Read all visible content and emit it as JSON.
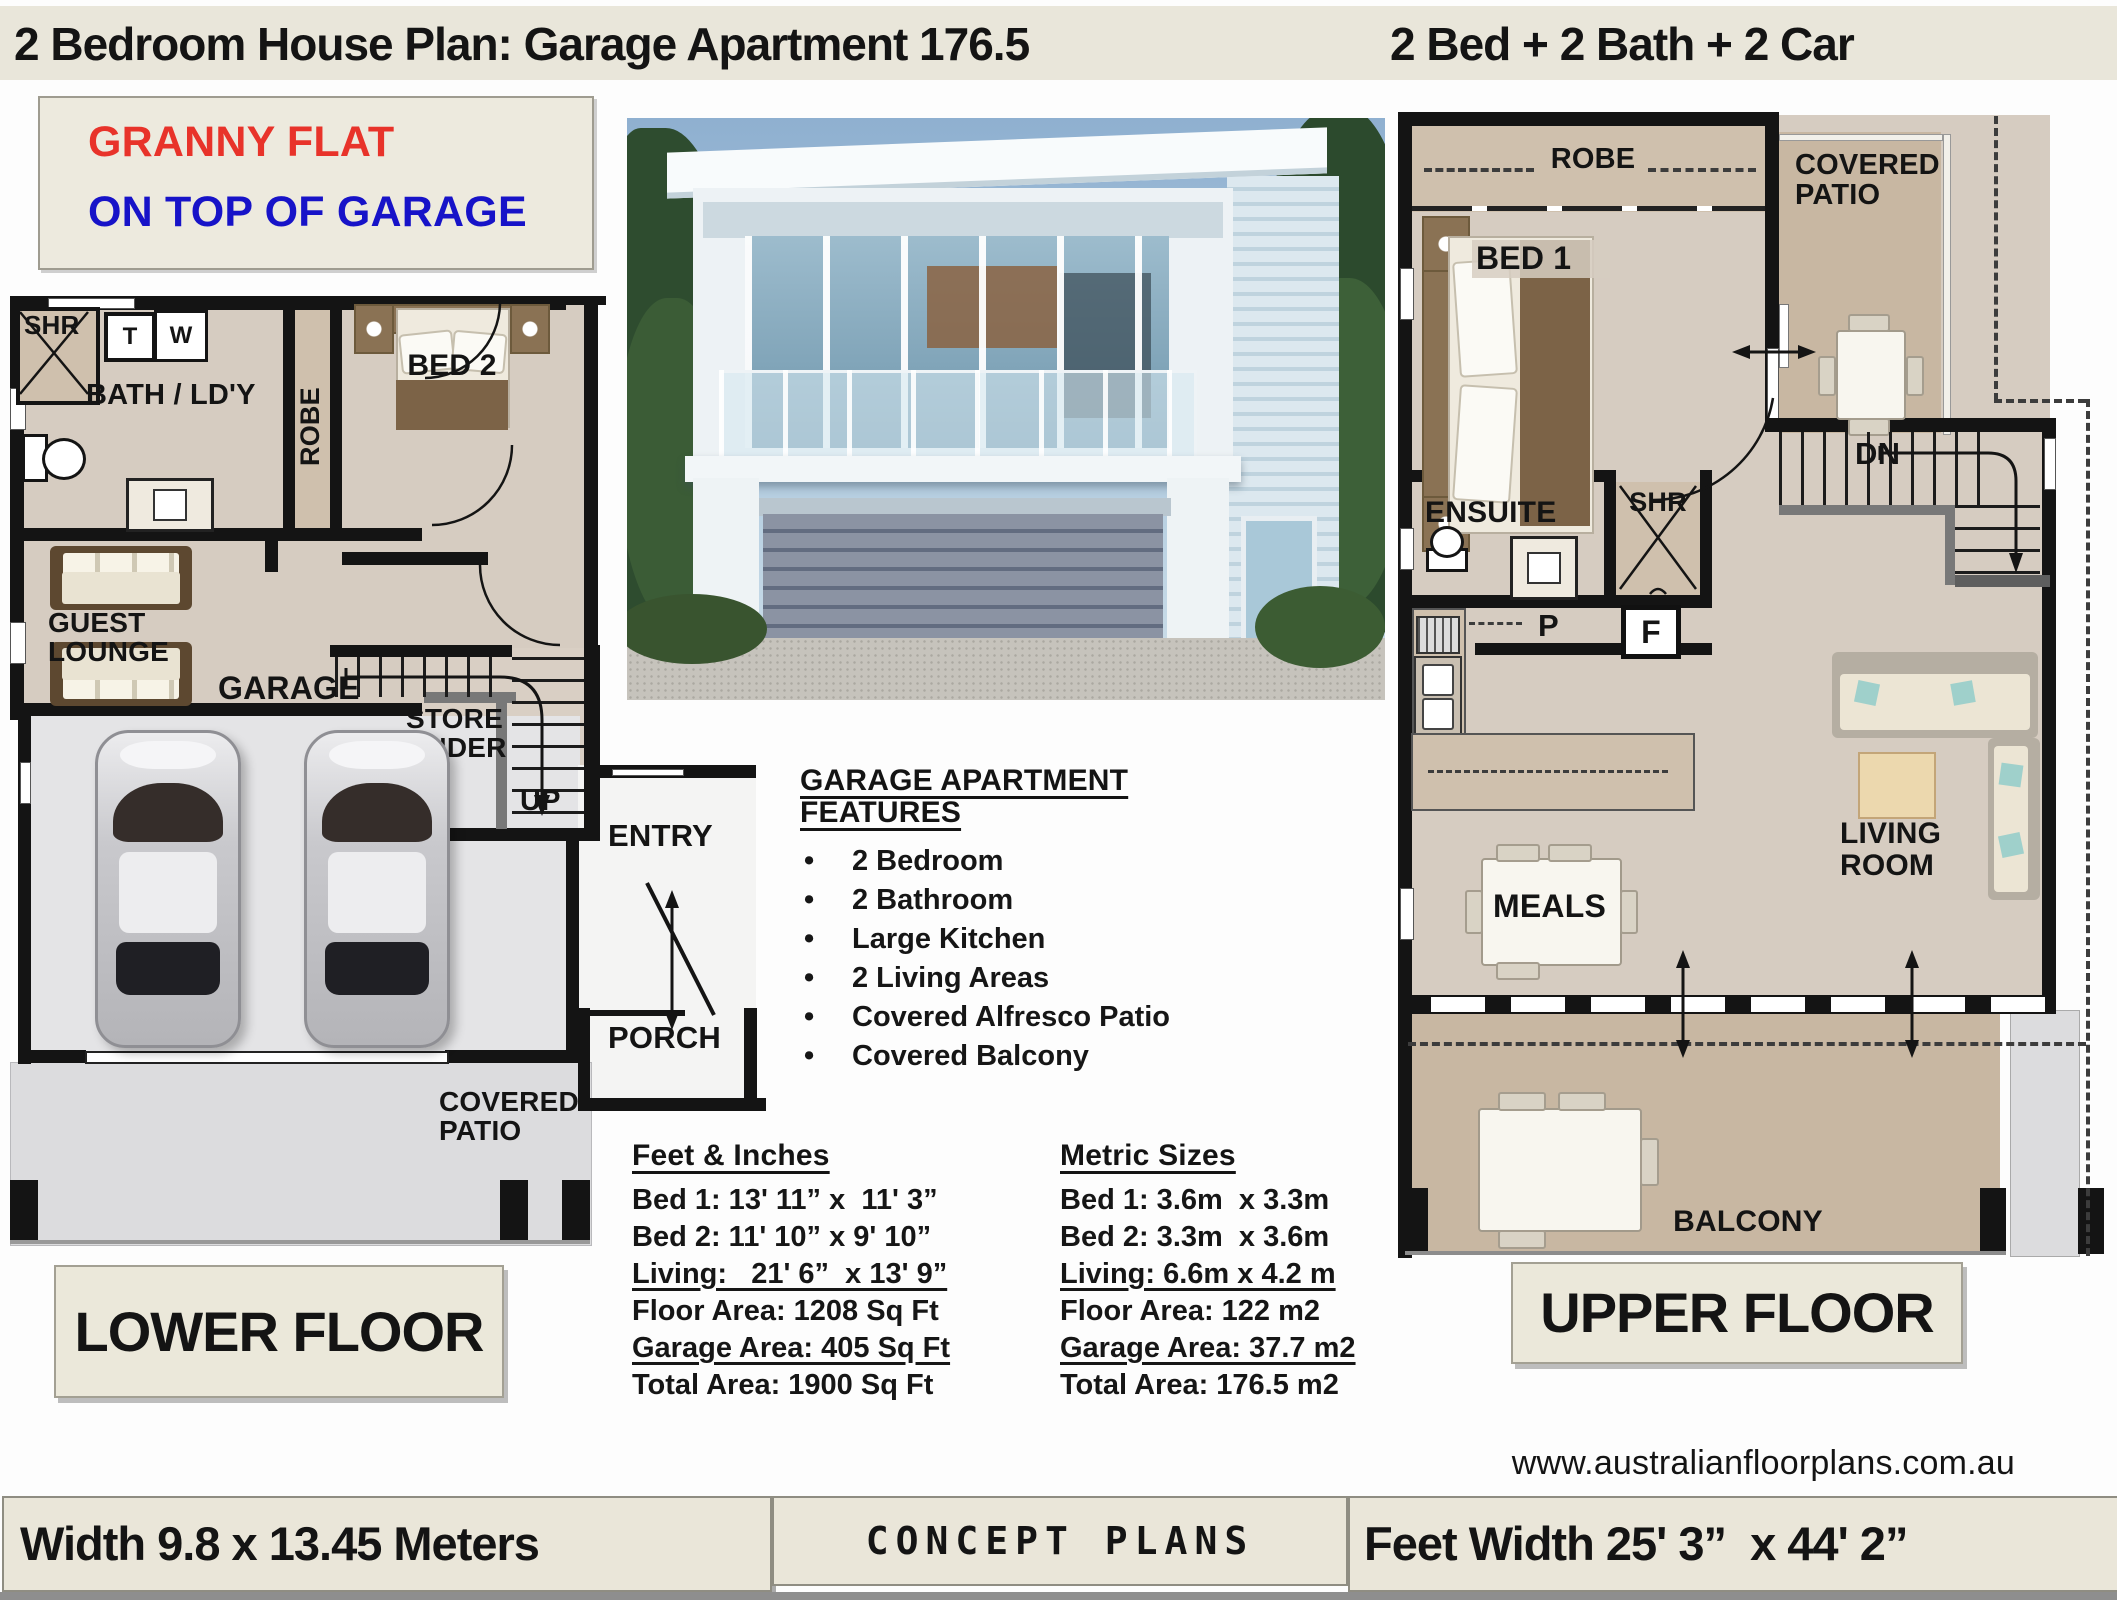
{
  "header": {
    "title_left": "2 Bedroom House Plan: Garage Apartment 176.5",
    "title_right": "2 Bed + 2 Bath + 2 Car"
  },
  "granny_box": {
    "line1": "GRANNY FLAT",
    "line2": "ON TOP OF GARAGE"
  },
  "colors": {
    "granny_line1": "#e8332a",
    "granny_line2": "#1713c8",
    "title_bar": "#e9e6da",
    "wall": "#141414",
    "floor_beige": "#d6ccc1",
    "floor_tan": "#c8b7a2",
    "garage_gray": "#e4e4e6",
    "patio_gray": "#dcdcde",
    "box_beige": "#ebe8da"
  },
  "lower_plan": {
    "rooms": {
      "shr": "SHR",
      "t": "T",
      "w": "W",
      "bath": "BATH / LD'Y",
      "robe": "ROBE",
      "bed2": "BED 2",
      "guest_lounge": "GUEST LOUNGE",
      "store_under": "STORE UNDER",
      "up": "UP",
      "garage": "GARAGE",
      "entry": "ENTRY",
      "porch": "PORCH",
      "covered_patio": "COVERED PATIO"
    }
  },
  "upper_plan": {
    "rooms": {
      "robe": "ROBE",
      "bed1": "BED 1",
      "covered_patio": "COVERED PATIO",
      "ensuite": "ENSUITE",
      "shr": "SHR",
      "dn": "DN",
      "p": "P",
      "f": "F",
      "living_room": "LIVING ROOM",
      "meals": "MEALS",
      "balcony": "BALCONY"
    }
  },
  "floor_labels": {
    "lower": "LOWER FLOOR",
    "upper": "UPPER FLOOR"
  },
  "features": {
    "heading": "GARAGE APARTMENT FEATURES",
    "items": [
      "2 Bedroom",
      "2 Bathroom",
      "Large Kitchen",
      "2 Living Areas",
      "Covered Alfresco Patio",
      "Covered Balcony"
    ]
  },
  "dimensions": {
    "feet": {
      "heading": "Feet & Inches",
      "rows": [
        "Bed 1: 13' 11” x  11' 3”",
        "Bed 2: 11' 10” x 9' 10”",
        "Living:   21' 6”  x 13' 9”",
        "Floor Area: 1208 Sq Ft",
        "Garage Area: 405 Sq Ft",
        "Total Area: 1900 Sq Ft"
      ]
    },
    "metric": {
      "heading": "Metric Sizes",
      "rows": [
        "Bed 1: 3.6m  x 3.3m",
        "Bed 2: 3.3m  x 3.6m",
        "Living: 6.6m x 4.2 m",
        "Floor Area: 122 m2",
        "Garage Area: 37.7 m2",
        "Total Area: 176.5 m2"
      ]
    }
  },
  "website": "www.australianfloorplans.com.au",
  "footer": {
    "left": "Width 9.8 x 13.45 Meters",
    "center": "CONCEPT PLANS",
    "right": "Feet Width 25' 3”  x 44' 2”"
  }
}
